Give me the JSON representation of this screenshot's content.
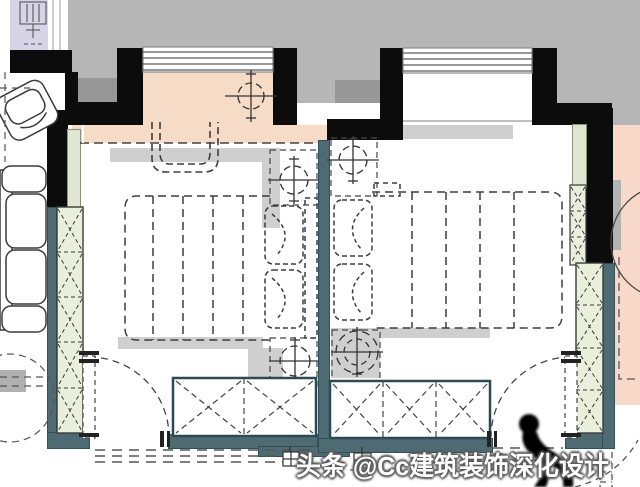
{
  "watermark": {
    "text": "头条 @Cc建筑装饰深化设计",
    "figure_icon": "person-silhouette"
  },
  "colors": {
    "exterior": "#b7b6b6",
    "exteriorDark": "#979797",
    "wallBlack": "#0c0c0c",
    "wallSlate": "#4e6b74",
    "wallSlateEdge": "#32505a",
    "balconyPeach": "#f6dcc6",
    "adjacentPink": "#f8d9c9",
    "lavender": "#d8d4e7",
    "wardrobeGreen": "#e9efdb",
    "wardrobePale": "#e0e6d1",
    "shadow": "#cfcfcf",
    "line": "#3d3d3d",
    "watermarkWhite": "#ffffff"
  },
  "plan": {
    "drawing_type": "furniture-plan",
    "rooms": [
      {
        "name": "bedroom-left",
        "items": [
          "balcony-window",
          "ceiling-light",
          "double-bed",
          "two-pillows",
          "headboard",
          "nightstand-light-top",
          "nightstand-light-bottom",
          "side-wall-wardrobe",
          "bottom-wardrobe-2-cells",
          "swing-door"
        ]
      },
      {
        "name": "bedroom-right",
        "items": [
          "window-bay",
          "double-bed",
          "two-pillows",
          "nightstand-light-top",
          "nightstand-light-bottom",
          "side-wall-wardrobe",
          "bottom-wardrobe-3-cells",
          "swing-door"
        ]
      },
      {
        "name": "adjacent-room-right",
        "items": [
          "round-table",
          "dashed-boundary"
        ]
      },
      {
        "name": "living-area-left",
        "items": [
          "armchair",
          "sofa",
          "round-table"
        ]
      },
      {
        "name": "corridor-top-left",
        "items": [
          "fixture-symbol"
        ]
      }
    ],
    "symbols": [
      {
        "name": "ceiling-light-symbol",
        "glyph": "dashed-circle-with-crosshair"
      },
      {
        "name": "door-swing-symbol",
        "glyph": "quarter-arc-with-leaf"
      },
      {
        "name": "wardrobe-symbol",
        "glyph": "box-with-dashed-x"
      },
      {
        "name": "window-symbol",
        "glyph": "parallel-lines"
      },
      {
        "name": "socket-symbol",
        "glyph": "small-gridded-square"
      }
    ]
  }
}
